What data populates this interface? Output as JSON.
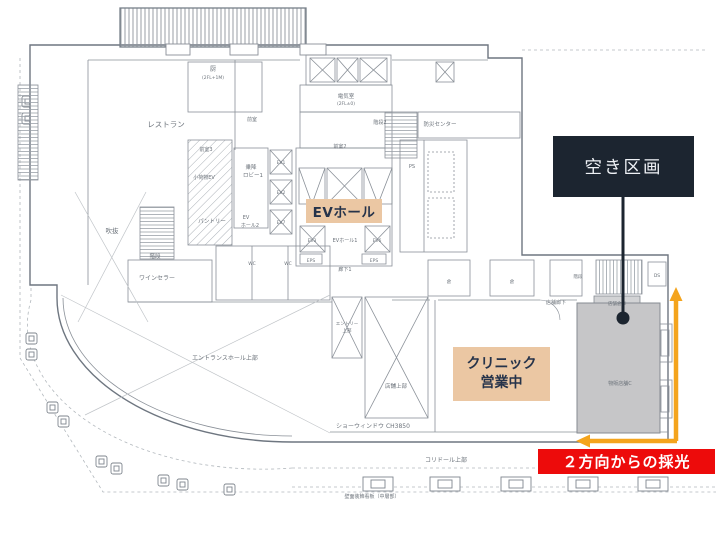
{
  "colors": {
    "highlight_beige": "#EBC7A3",
    "callout_dark_bg": "#1C2530",
    "callout_dark_text": "#EEF1F5",
    "alert_red": "#ED0B0B",
    "accent_orange": "#F4A41D",
    "vacant_gray_fill": "#C6C6C8",
    "plan_line": "#8A9098"
  },
  "callouts": {
    "vacant": {
      "label": "空き区画"
    },
    "ev_hall": {
      "label": "EVホール"
    },
    "clinic": {
      "line1": "クリニック",
      "line2": "営業中"
    },
    "daylight": {
      "label": "２方向からの採光"
    }
  },
  "plan": {
    "labels": [
      {
        "text": "レストラン",
        "x": 166,
        "y": 127,
        "size": 7.5
      },
      {
        "text": "厨",
        "x": 213,
        "y": 71,
        "size": 6
      },
      {
        "text": "(2FL+1M)",
        "x": 213,
        "y": 79,
        "size": 4.5
      },
      {
        "text": "前室",
        "x": 252,
        "y": 121,
        "size": 5
      },
      {
        "text": "前室3",
        "x": 206,
        "y": 151,
        "size": 5
      },
      {
        "text": "前室2",
        "x": 340,
        "y": 148,
        "size": 5
      },
      {
        "text": "吹抜",
        "x": 112,
        "y": 233,
        "size": 6.5
      },
      {
        "text": "階段",
        "x": 155,
        "y": 258,
        "size": 5.5
      },
      {
        "text": "ワインセラー",
        "x": 157,
        "y": 280,
        "size": 6
      },
      {
        "text": "小荷物EV",
        "x": 204,
        "y": 179,
        "size": 5
      },
      {
        "text": "パントリー",
        "x": 212,
        "y": 223,
        "size": 5.5
      },
      {
        "text": "乗降",
        "x": 251,
        "y": 169,
        "size": 5.5
      },
      {
        "text": "ロビー1",
        "x": 253,
        "y": 177,
        "size": 5.5
      },
      {
        "text": "EV1",
        "x": 281,
        "y": 164,
        "size": 4.5
      },
      {
        "text": "EV2",
        "x": 281,
        "y": 194,
        "size": 4.5
      },
      {
        "text": "EV7",
        "x": 281,
        "y": 224,
        "size": 4.5
      },
      {
        "text": "EV",
        "x": 246,
        "y": 219,
        "size": 5
      },
      {
        "text": "ホール2",
        "x": 250,
        "y": 227,
        "size": 5
      },
      {
        "text": "電気室",
        "x": 346,
        "y": 98,
        "size": 5.5
      },
      {
        "text": "(2FL±0)",
        "x": 346,
        "y": 105,
        "size": 4.5
      },
      {
        "text": "階段2",
        "x": 380,
        "y": 124,
        "size": 5
      },
      {
        "text": "防災センター",
        "x": 440,
        "y": 126,
        "size": 5.5
      },
      {
        "text": "PS",
        "x": 412,
        "y": 168,
        "size": 5
      },
      {
        "text": "EV3",
        "x": 312,
        "y": 242,
        "size": 4.5
      },
      {
        "text": "EVホール1",
        "x": 345,
        "y": 242,
        "size": 5
      },
      {
        "text": "EV6",
        "x": 377,
        "y": 242,
        "size": 4.5
      },
      {
        "text": "EPS",
        "x": 311,
        "y": 262,
        "size": 4.5
      },
      {
        "text": "EPS",
        "x": 374,
        "y": 262,
        "size": 4.5
      },
      {
        "text": "廊下1",
        "x": 345,
        "y": 271,
        "size": 5
      },
      {
        "text": "WC",
        "x": 252,
        "y": 265,
        "size": 4.5
      },
      {
        "text": "WC",
        "x": 288,
        "y": 265,
        "size": 4.5
      },
      {
        "text": "店舗廊下",
        "x": 556,
        "y": 304,
        "size": 5
      },
      {
        "text": "倉",
        "x": 449,
        "y": 283,
        "size": 4.5
      },
      {
        "text": "倉",
        "x": 512,
        "y": 283,
        "size": 4.5
      },
      {
        "text": "階段",
        "x": 578,
        "y": 278,
        "size": 4.5
      },
      {
        "text": "DS",
        "x": 657,
        "y": 277,
        "size": 4.5
      },
      {
        "text": "店舗倉庫",
        "x": 617,
        "y": 305,
        "size": 4.5
      },
      {
        "text": "物販店舗C",
        "x": 620,
        "y": 385,
        "size": 5
      },
      {
        "text": "エントランスホール上部",
        "x": 225,
        "y": 360,
        "size": 6
      },
      {
        "text": "エントリー",
        "x": 347,
        "y": 325,
        "size": 4.5
      },
      {
        "text": "上部",
        "x": 347,
        "y": 332,
        "size": 4.5
      },
      {
        "text": "店舗上部",
        "x": 396,
        "y": 388,
        "size": 5.5
      },
      {
        "text": "ショーウィンドウ CH3850",
        "x": 373,
        "y": 428,
        "size": 6
      },
      {
        "text": "コリドール上部",
        "x": 446,
        "y": 462,
        "size": 6
      },
      {
        "text": "壁面装飾看板（中層部）",
        "x": 372,
        "y": 498,
        "size": 5
      }
    ]
  }
}
